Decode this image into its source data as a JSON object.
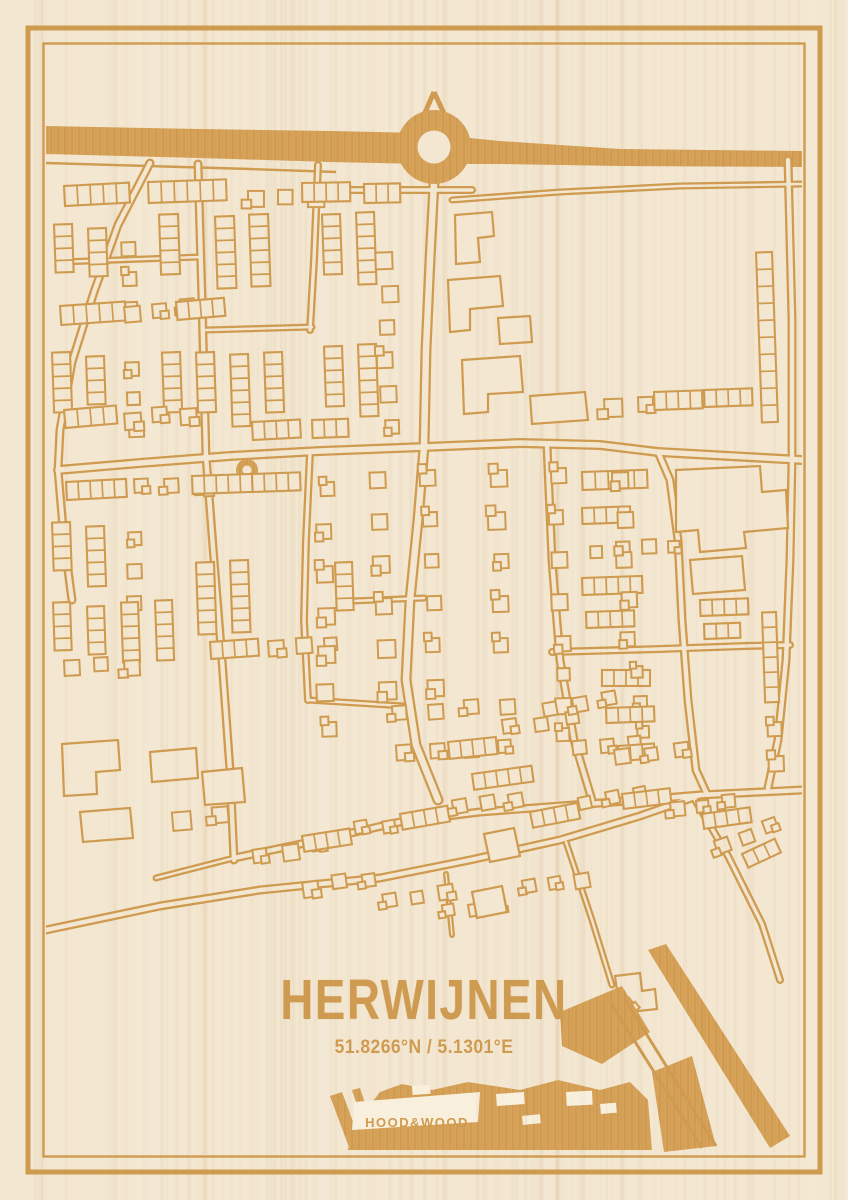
{
  "poster": {
    "title": "HERWIJNEN",
    "coordinates": "51.8266°N / 5.1301°E",
    "brand": "HOOD&WOOD",
    "colors": {
      "wood": "#f3e7d1",
      "wood_light": "#f8efdd",
      "engrave_line": "#cf9b50",
      "engrave_fill": "#d7a35a",
      "engrave_dark": "#b9832f",
      "grain": "#b98a4e"
    }
  }
}
